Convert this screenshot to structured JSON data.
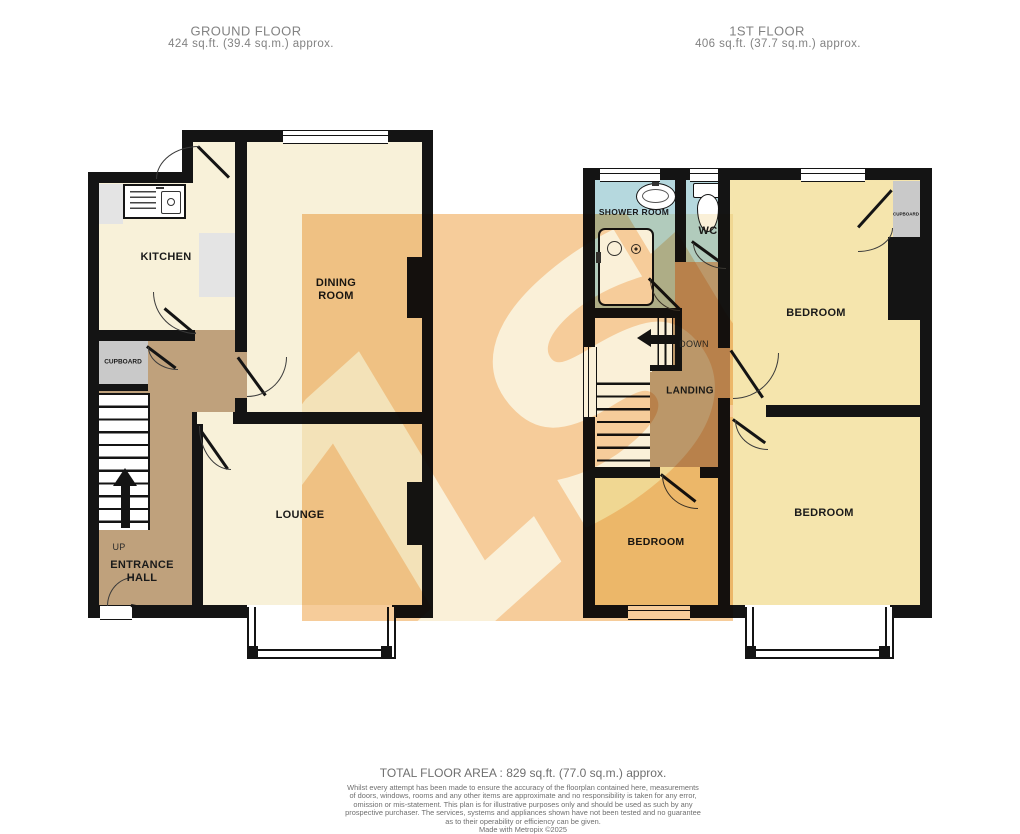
{
  "floors": {
    "ground": {
      "title": "GROUND FLOOR",
      "area": "424 sq.ft. (39.4 sq.m.) approx."
    },
    "first": {
      "title": "1ST FLOOR",
      "area": "406 sq.ft. (37.7 sq.m.) approx."
    }
  },
  "rooms": {
    "kitchen": "KITCHEN",
    "dining_room": [
      "DINING",
      "ROOM"
    ],
    "lounge": "LOUNGE",
    "entrance_hall": [
      "ENTRANCE",
      "HALL"
    ],
    "cupboard_ground": "CUPBOARD",
    "shower_room": "SHOWER ROOM",
    "wc": "WC",
    "landing": "LANDING",
    "bedroom_back": "BEDROOM",
    "bedroom_small": "BEDROOM",
    "bedroom_front": "BEDROOM",
    "cupboard_first": "CUPBOARD"
  },
  "stairs": {
    "up_label": "UP",
    "down_label": "DOWN"
  },
  "watermark_text": "1st",
  "footer": {
    "total_area": "TOTAL FLOOR AREA : 829 sq.ft. (77.0 sq.m.) approx.",
    "disclaimer_lines": [
      "Whilst every attempt has been made to ensure the accuracy of the floorplan contained here, measurements",
      "of doors, windows, rooms and any other items are approximate and no responsibility is taken for any error,",
      "omission or mis-statement. This plan is for illustrative purposes only and should be used as such by any",
      "prospective purchaser. The services, systems and appliances shown have not been tested and no guarantee",
      "as to their operability or efficiency can be given.",
      "Made with Metropix ©2025"
    ]
  },
  "colors": {
    "wall": "#141414",
    "room_cream": "#f8f1d9",
    "room_yellow": "#f5e5ad",
    "room_blue": "#b5d8de",
    "hall_brown": "#bfa17c",
    "cupboard_gray": "#c9c9c9",
    "watermark_orange": "#f6cc9a",
    "watermark_cream": "#faf0d8",
    "heading_gray": "#828282"
  }
}
